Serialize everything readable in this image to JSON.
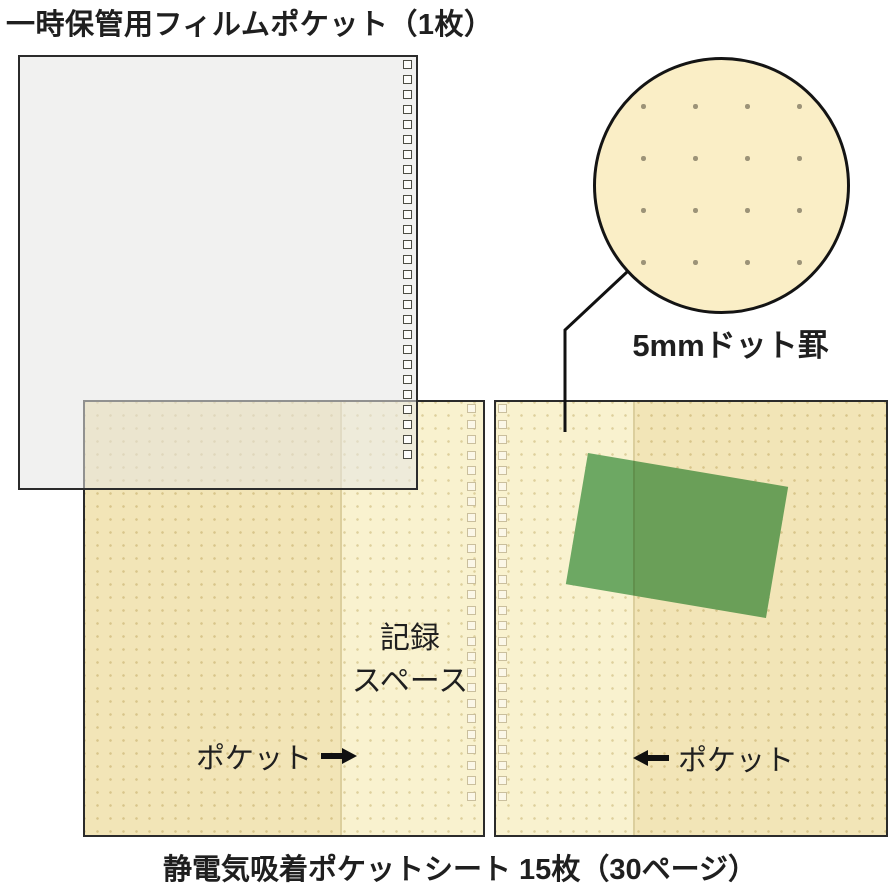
{
  "labels": {
    "title": "一時保管用フィルムポケット（1枚）",
    "magnifier_caption": "5mmドット罫",
    "recording_space": [
      "記録",
      "スペース"
    ],
    "pocket_left": "ポケット",
    "pocket_right": "ポケット",
    "bottom_caption": "静電気吸着ポケットシート 15枚（30ページ）"
  },
  "icons": {
    "pocket_arrow_left": "left-arrow-icon",
    "pocket_arrow_right": "right-arrow-icon"
  },
  "colors": {
    "film_fill": "rgba(229,229,227,0.55)",
    "sheet_base": "#f9f2cf",
    "sheet_dot": "rgba(200,180,115,0.55)",
    "pocket_tint": "#f8f2e2",
    "card_green": "#6da863",
    "circle_fill": "#faeec6",
    "mag_dot": "#9c9378"
  },
  "decor": {
    "film_hole_count": 27,
    "sheet_hole_count": 26,
    "magnifier_dot_rows": 4,
    "magnifier_dot_cols": 4,
    "magnifier_dot_pitch_px": 52,
    "sheet_dot_pitch_px": 13
  }
}
